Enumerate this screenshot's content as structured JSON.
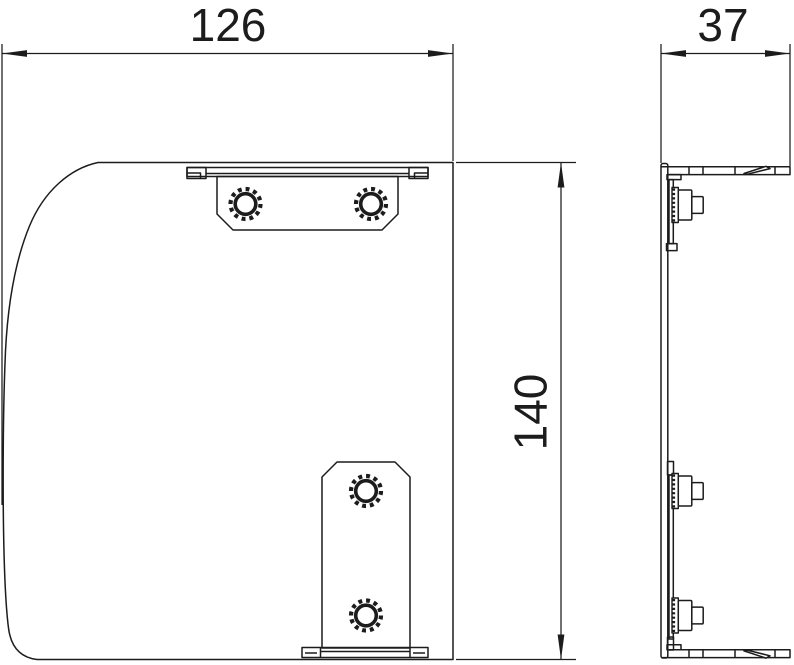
{
  "drawing": {
    "background_color": "#ffffff",
    "line_color": "#1c1c1c",
    "dimensions": {
      "width": {
        "label": "126"
      },
      "depth": {
        "label": "37"
      },
      "height": {
        "label": "140"
      }
    }
  }
}
